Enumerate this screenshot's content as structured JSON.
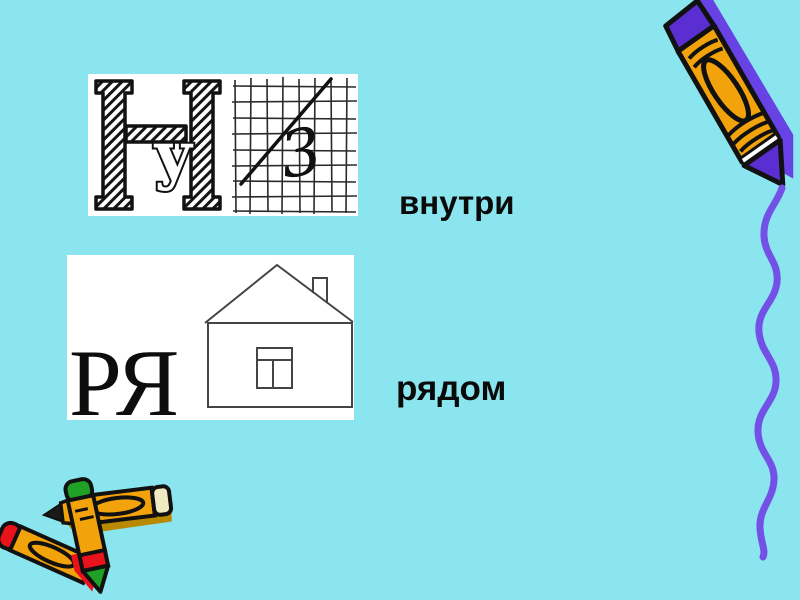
{
  "slide": {
    "background_color": "#8BE5EE",
    "words": [
      {
        "id": "inside",
        "text": "внутри"
      },
      {
        "id": "beside",
        "text": "рядом"
      }
    ],
    "rebus_inside": {
      "big_letter": "Н",
      "inner_letter": "у",
      "digit": "3"
    },
    "rebus_beside": {
      "letters": "РЯ"
    },
    "icons": {
      "top_right": "crayon-clipart",
      "top_right_line": "purple-scribble-line",
      "bottom_left": "crossed-crayons-clipart",
      "rebus1_left": "sketch-letter-n-icon",
      "rebus1_right": "grid-paper-icon",
      "rebus2_right": "house-drawing-icon"
    },
    "colors": {
      "background": "#8BE5EE",
      "card_background": "#FFFFFF",
      "text": "#0A0A0A",
      "ink": "#111111",
      "crayon_orange": "#F2A30B",
      "crayon_purple": "#5B2ED2",
      "crayon_shadow_purple": "#6743E6",
      "squiggle_purple": "#7350E6",
      "cap_red": "#E8131B",
      "cap_green": "#1FA125",
      "cap_cream": "#EFEAC1",
      "pencil_shadow_olive": "#B98A00",
      "house_line": "#444444"
    }
  }
}
